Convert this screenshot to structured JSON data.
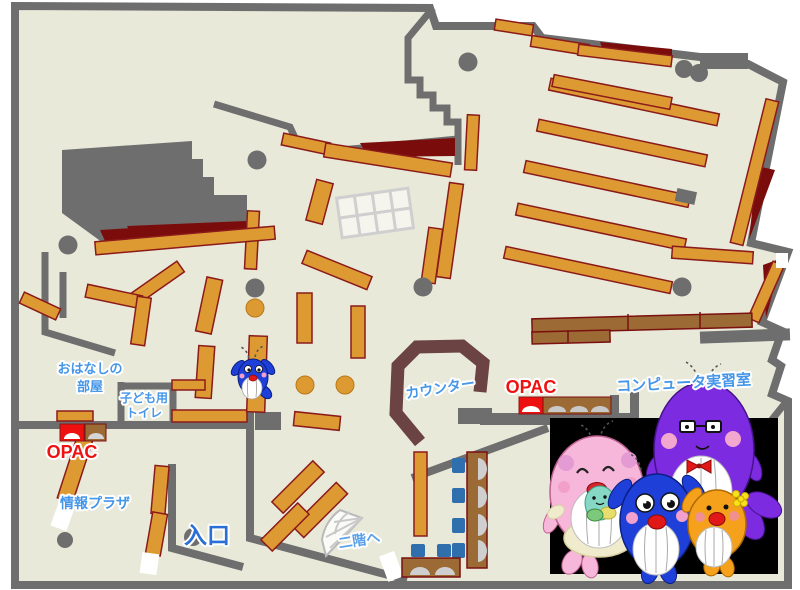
{
  "map": {
    "title": "library-first-floor-map",
    "labels": {
      "story_room_1": "おはなしの",
      "story_room_2": "部屋",
      "kids_toilet_1": "子ども用",
      "kids_toilet_2": "トイレ",
      "opac_left": "OPAC",
      "opac_center": "OPAC",
      "info_plaza": "情報プラザ",
      "entrance": "入口",
      "counter": "カウンター",
      "computer_room": "コンピュータ実習室",
      "to_second_floor": "二階へ"
    },
    "colors": {
      "floor": "#e9e9da",
      "wall_gray": "#6e6e6e",
      "shelf_orange": "#dd9a33",
      "shelf_border": "#8b1a1a",
      "desk_brown": "#9c6a34",
      "accent_dark_red": "#7a0c0c",
      "counter_brown": "#6b4343",
      "chair_blue": "#2f6fae",
      "label_blue": "#4596e8",
      "entrance_blue": "#2a6fd6",
      "opac_red": "#ee1111",
      "mascot_panel": "#000000"
    },
    "mascots": {
      "on_map": "blue-whale",
      "panel": [
        "pink-whale-mother",
        "purple-whale-father",
        "blue-whale-child",
        "orange-whale-child",
        "green-baby-whale"
      ]
    }
  }
}
